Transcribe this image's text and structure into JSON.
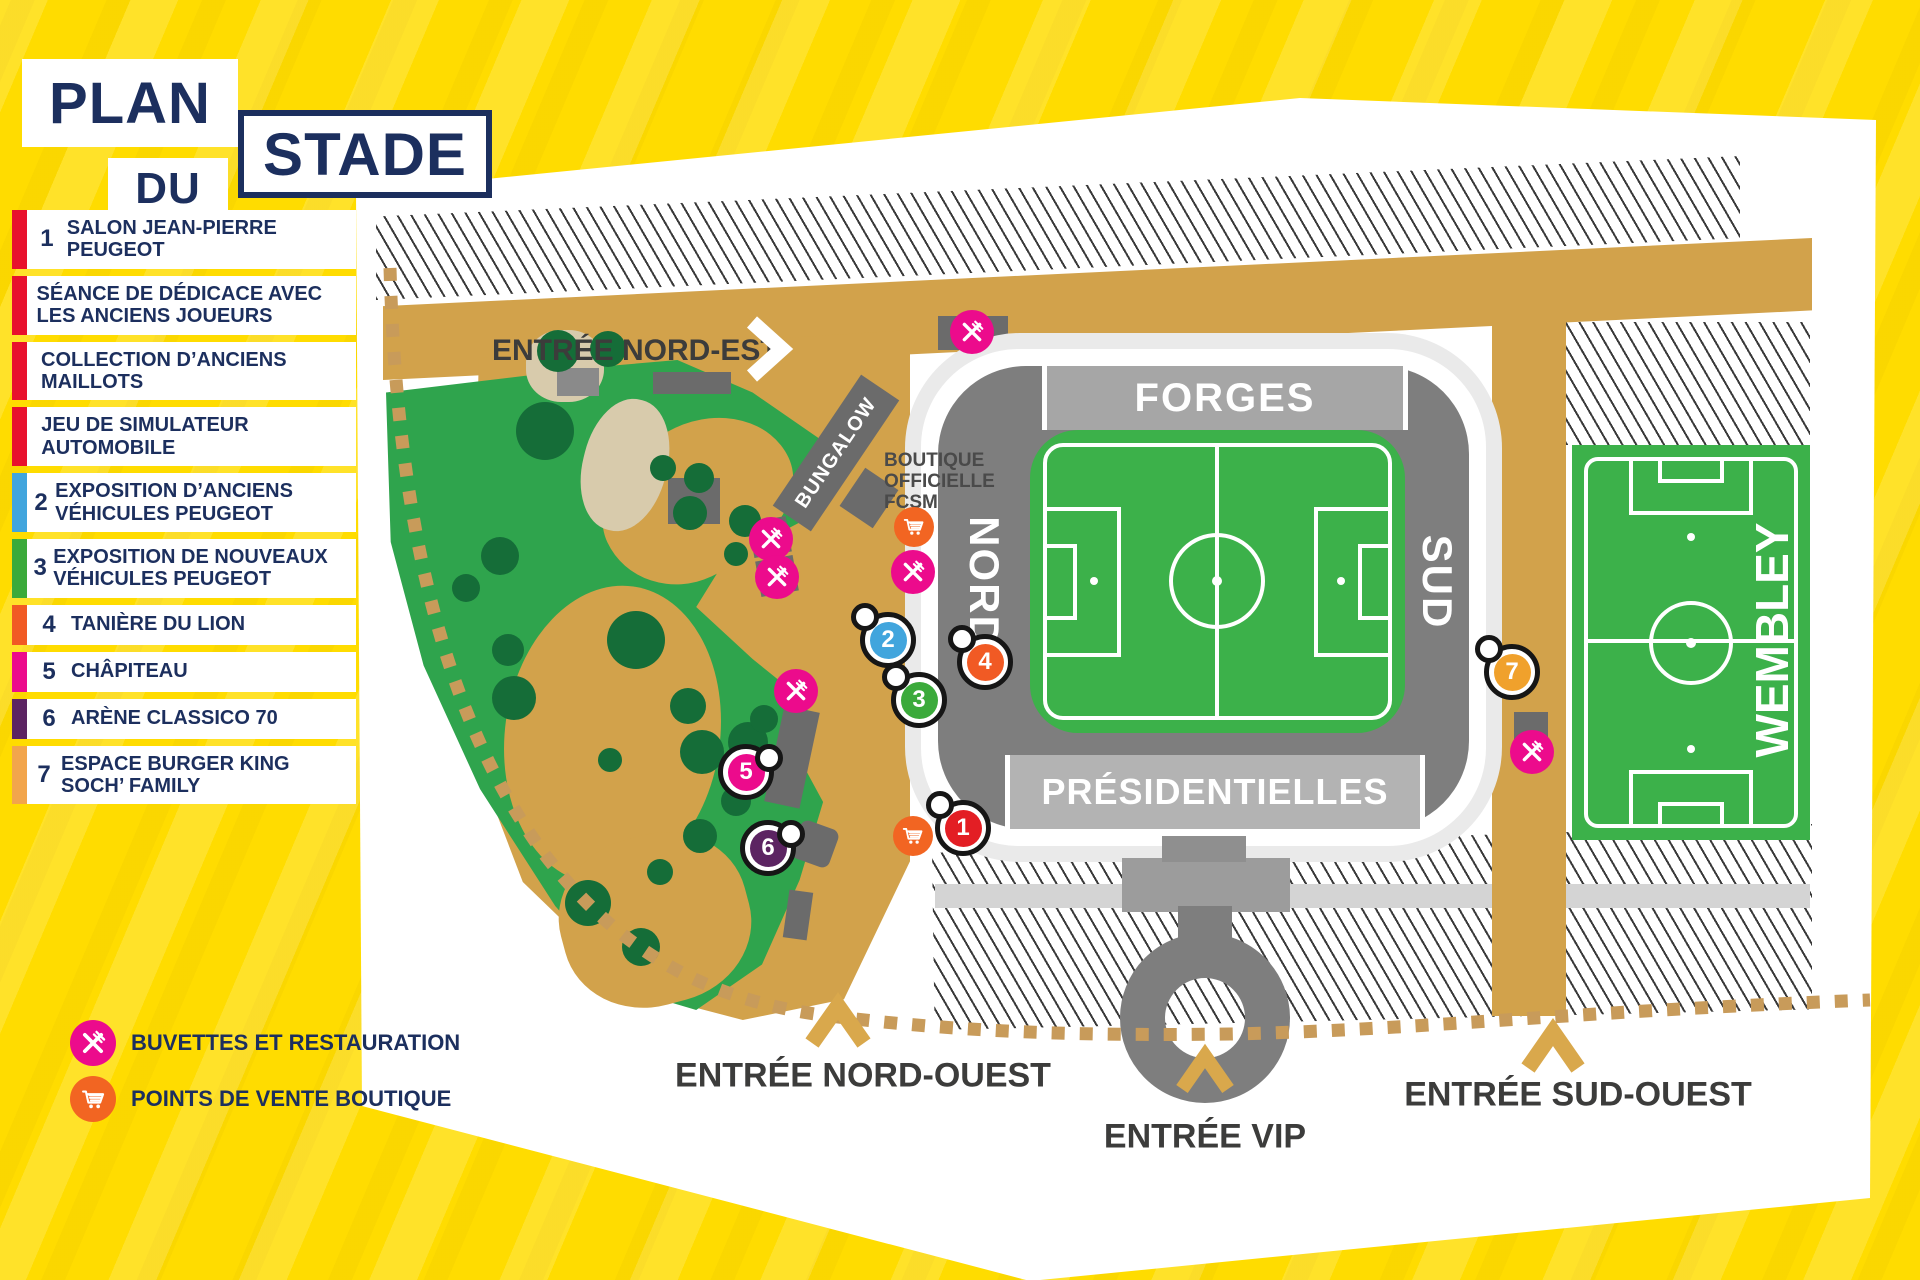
{
  "title": {
    "plan": "PLAN",
    "du": "DU",
    "stade": "STADE"
  },
  "legend": {
    "items": [
      {
        "num": "1",
        "label": "SALON JEAN-PIERRE PEUGEOT",
        "color": "#E8112D"
      },
      {
        "num": "",
        "label": "SÉANCE DE DÉDICACE AVEC LES ANCIENS JOUEURS",
        "color": "#E8112D"
      },
      {
        "num": "",
        "label": "COLLECTION D’ANCIENS MAILLOTS",
        "color": "#E8112D"
      },
      {
        "num": "",
        "label": "JEU DE SIMULATEUR AUTOMOBILE",
        "color": "#E8112D"
      },
      {
        "num": "2",
        "label": "EXPOSITION D’ANCIENS VÉHICULES PEUGEOT",
        "color": "#41A5DD"
      },
      {
        "num": "3",
        "label": "EXPOSITION DE NOUVEAUX VÉHICULES PEUGEOT",
        "color": "#3BAA3B"
      },
      {
        "num": "4",
        "label": "TANIÈRE DU LION",
        "color": "#F15A24"
      },
      {
        "num": "5",
        "label": "CHÂPITEAU",
        "color": "#EC0B8C"
      },
      {
        "num": "6",
        "label": "ARÈNE CLASSICO 70",
        "color": "#5C2462"
      },
      {
        "num": "7",
        "label": "ESPACE BURGER KING SOCH’ FAMILY",
        "color": "#F2A54C"
      }
    ]
  },
  "key": {
    "food_label": "BUVETTES ET RESTAURATION",
    "shop_label": "POINTS DE VENTE BOUTIQUE"
  },
  "map": {
    "entrances": {
      "north_east": "ENTRÉE NORD-EST",
      "north_west": "ENTRÉE NORD-OUEST",
      "vip": "ENTRÉE VIP",
      "south_west": "ENTRÉE SUD-OUEST"
    },
    "stands": {
      "forges": "FORGES",
      "north": "NORD",
      "south": "SUD",
      "presidentielles": "PRÉSIDENTIELLES"
    },
    "labels": {
      "bungalow": "BUNGALOW",
      "boutique_lines": [
        "BOUTIQUE",
        "OFFICIELLE",
        "FCSM"
      ],
      "wembley": "WEMBLEY"
    },
    "markers": [
      {
        "num": "1",
        "color": "#E31E24"
      },
      {
        "num": "2",
        "color": "#41A5DD"
      },
      {
        "num": "3",
        "color": "#3BAA3B"
      },
      {
        "num": "4",
        "color": "#F15A24"
      },
      {
        "num": "5",
        "color": "#EC0B8C"
      },
      {
        "num": "6",
        "color": "#5C2462"
      },
      {
        "num": "7",
        "color": "#F0A12C"
      }
    ]
  },
  "colors": {
    "background_yellow": "#FFDC00",
    "navy": "#1C2F5E",
    "tan_path": "#D2A24B",
    "dotted_path": "#C89B5A",
    "park_green": "#2FA44D",
    "tree_green": "#156D38",
    "pitch_green": "#3CB14A",
    "stand_dark_gray": "#7E7E7E",
    "stand_light_gray": "#A6A6A6",
    "food_pink": "#EC0B8C",
    "shop_orange": "#F26522",
    "map_label_gray": "#3C3C3B"
  }
}
